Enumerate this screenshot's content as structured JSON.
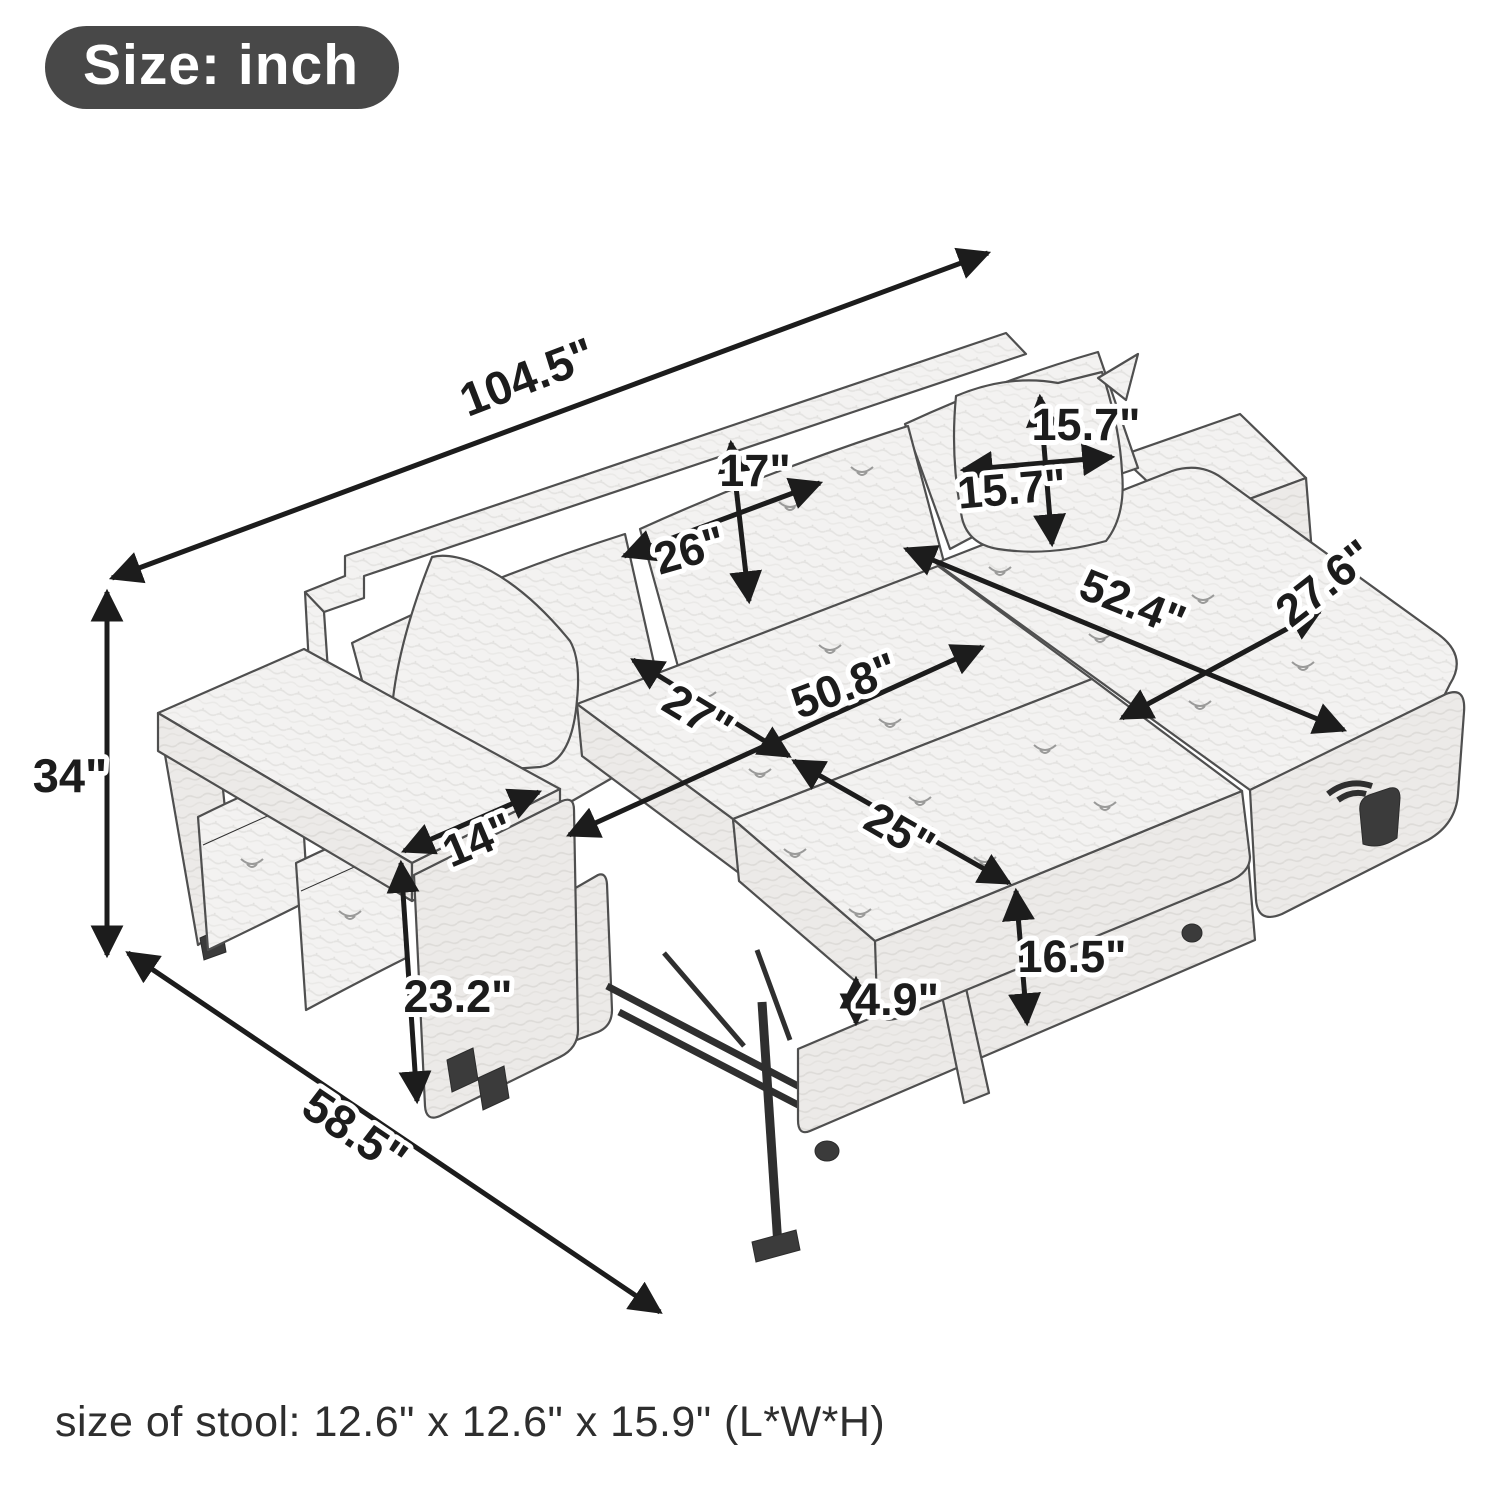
{
  "badge": {
    "label": "Size: inch",
    "bg_color": "#484848",
    "text_color": "#ffffff"
  },
  "diagram": {
    "subject": "L-shaped sleeper sectional sofa with pull-out bed, reversible storage chaise, armrest table and two ottoman stools",
    "unit": "inch",
    "dimensions": {
      "overall_length": "104.5\"",
      "overall_height": "34\"",
      "overall_depth": "58.5\"",
      "back_cushion_height": "17\"",
      "back_cushion_width": "26\"",
      "pillow_height": "15.7\"",
      "pillow_width": "15.7\"",
      "chaise_length": "52.4\"",
      "chaise_width": "27.6\"",
      "sleeper_length": "50.8\"",
      "seat_depth": "27\"",
      "pullout_width": "25\"",
      "sleeper_height": "16.5\"",
      "mattress_thickness": "4.9\"",
      "armrest_width": "14\"",
      "armrest_height": "23.2\""
    },
    "ink_color": "#1c1c1c",
    "sketch_line_color": "#4f4f4f"
  },
  "footer": {
    "stool_note": "size of stool: 12.6\" x 12.6\" x 15.9\" (L*W*H)"
  }
}
